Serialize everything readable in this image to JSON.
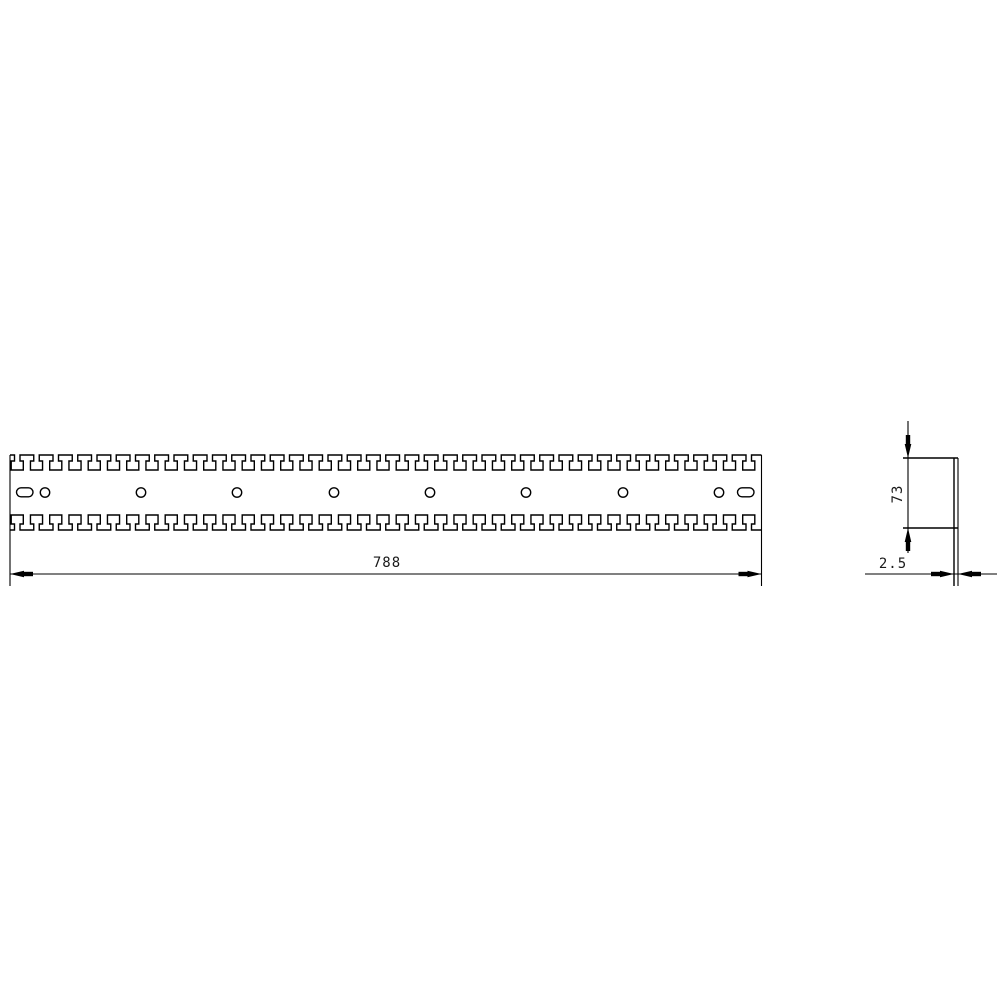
{
  "drawing": {
    "kind": "technical-drawing",
    "colors": {
      "line": "#000000",
      "background": "#ffffff"
    },
    "views": {
      "front": {
        "length_dim": "788",
        "circle_hole_count": 8,
        "end_slot_count": 2,
        "top_tooth_slot_count": 39,
        "bottom_tooth_slot_count": 39
      },
      "side": {
        "height_dim": "73",
        "thickness_dim": "2.5"
      }
    }
  }
}
